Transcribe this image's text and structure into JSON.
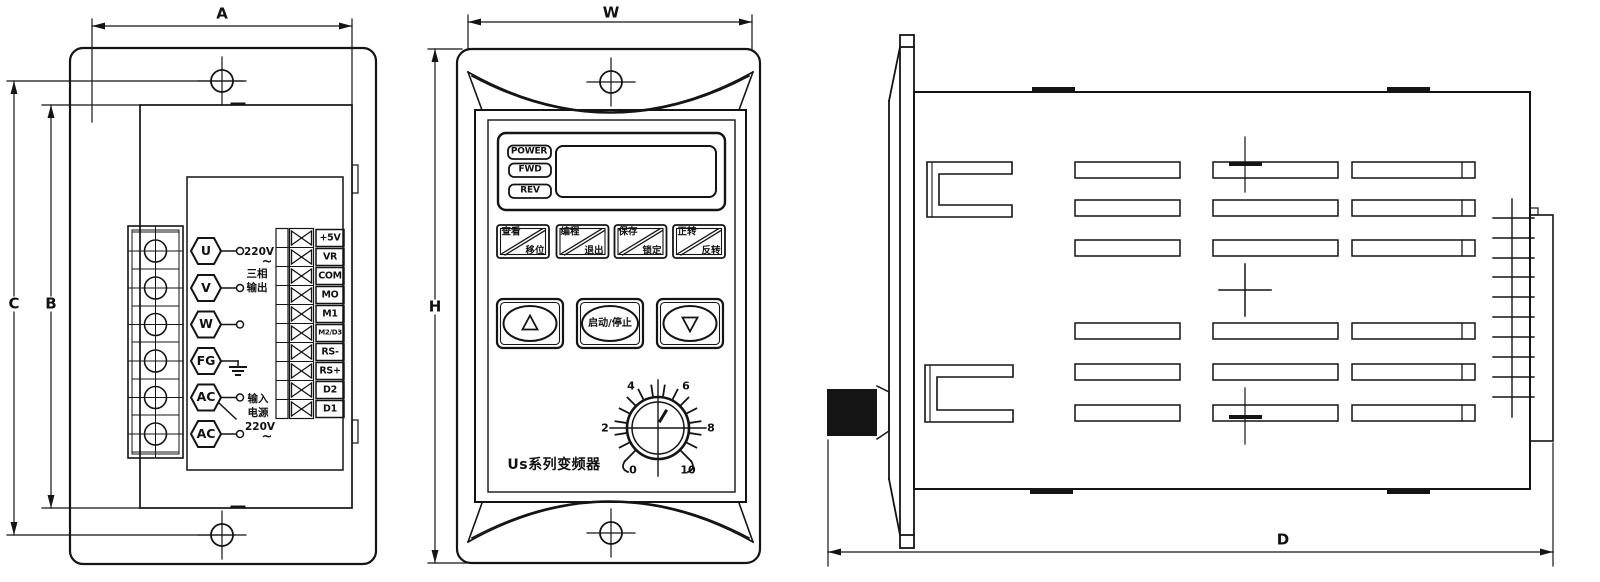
{
  "dims": {
    "a": "A",
    "w": "W",
    "c": "C",
    "b": "B",
    "h": "H",
    "d": "D"
  },
  "back_view": {
    "terminals": [
      "U",
      "V",
      "W",
      "FG",
      "AC",
      "AC"
    ],
    "output_note": {
      "volt": "220V",
      "tilde": "~",
      "line1": "三相",
      "line2": "输出"
    },
    "input_note": {
      "line1": "输入",
      "line2": "电源",
      "volt": "220V",
      "tilde": "~"
    },
    "strip": [
      "+5V",
      "VR",
      "COM",
      "MO",
      "M1",
      "M2/D3",
      "RS-",
      "RS+",
      "D2",
      "D1"
    ]
  },
  "front_view": {
    "indicators": [
      "POWER",
      "FWD",
      "REV"
    ],
    "keys": [
      {
        "top": "查看",
        "bottom": "移位"
      },
      {
        "top": "编程",
        "bottom": "退出"
      },
      {
        "top": "保存",
        "bottom": "锁定"
      },
      {
        "top": "正转",
        "bottom": "反转"
      }
    ],
    "run_key": "启动/停止",
    "scale": [
      "0",
      "2",
      "4",
      "6",
      "8",
      "10"
    ],
    "model": "Us系列变频器"
  }
}
